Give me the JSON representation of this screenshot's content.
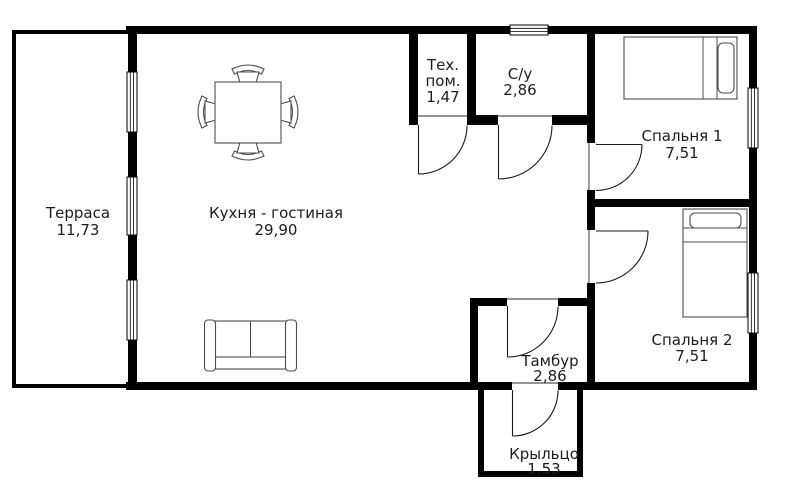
{
  "rooms": {
    "terrace": {
      "name": "Терраса",
      "area": "11,73"
    },
    "kitchen_living": {
      "name": "Кухня - гостиная",
      "area": "29,90"
    },
    "tech": {
      "name_line1": "Тех.",
      "name_line2": "пом.",
      "area": "1,47"
    },
    "bathroom": {
      "name": "С/у",
      "area": "2,86"
    },
    "bedroom1": {
      "name": "Спальня 1",
      "area": "7,51"
    },
    "bedroom2": {
      "name": "Спальня 2",
      "area": "7,51"
    },
    "vestibule": {
      "name": "Тамбур",
      "area": "2,86"
    },
    "porch": {
      "name": "Крыльцо",
      "area": "1,53"
    }
  },
  "furniture": [
    {
      "room": "kitchen_living",
      "icon": "dining-table-with-chairs-icon"
    },
    {
      "room": "kitchen_living",
      "icon": "sofa-icon"
    },
    {
      "room": "bedroom1",
      "icon": "single-bed-icon"
    },
    {
      "room": "bedroom2",
      "icon": "single-bed-icon"
    }
  ],
  "windows_count": 6,
  "doors_count": 6,
  "colors": {
    "wall": "#000000",
    "background": "#ffffff",
    "furniture_outline": "#4d4d4d",
    "door_line": "#1a1a1a",
    "text": "#1c1c1c"
  }
}
